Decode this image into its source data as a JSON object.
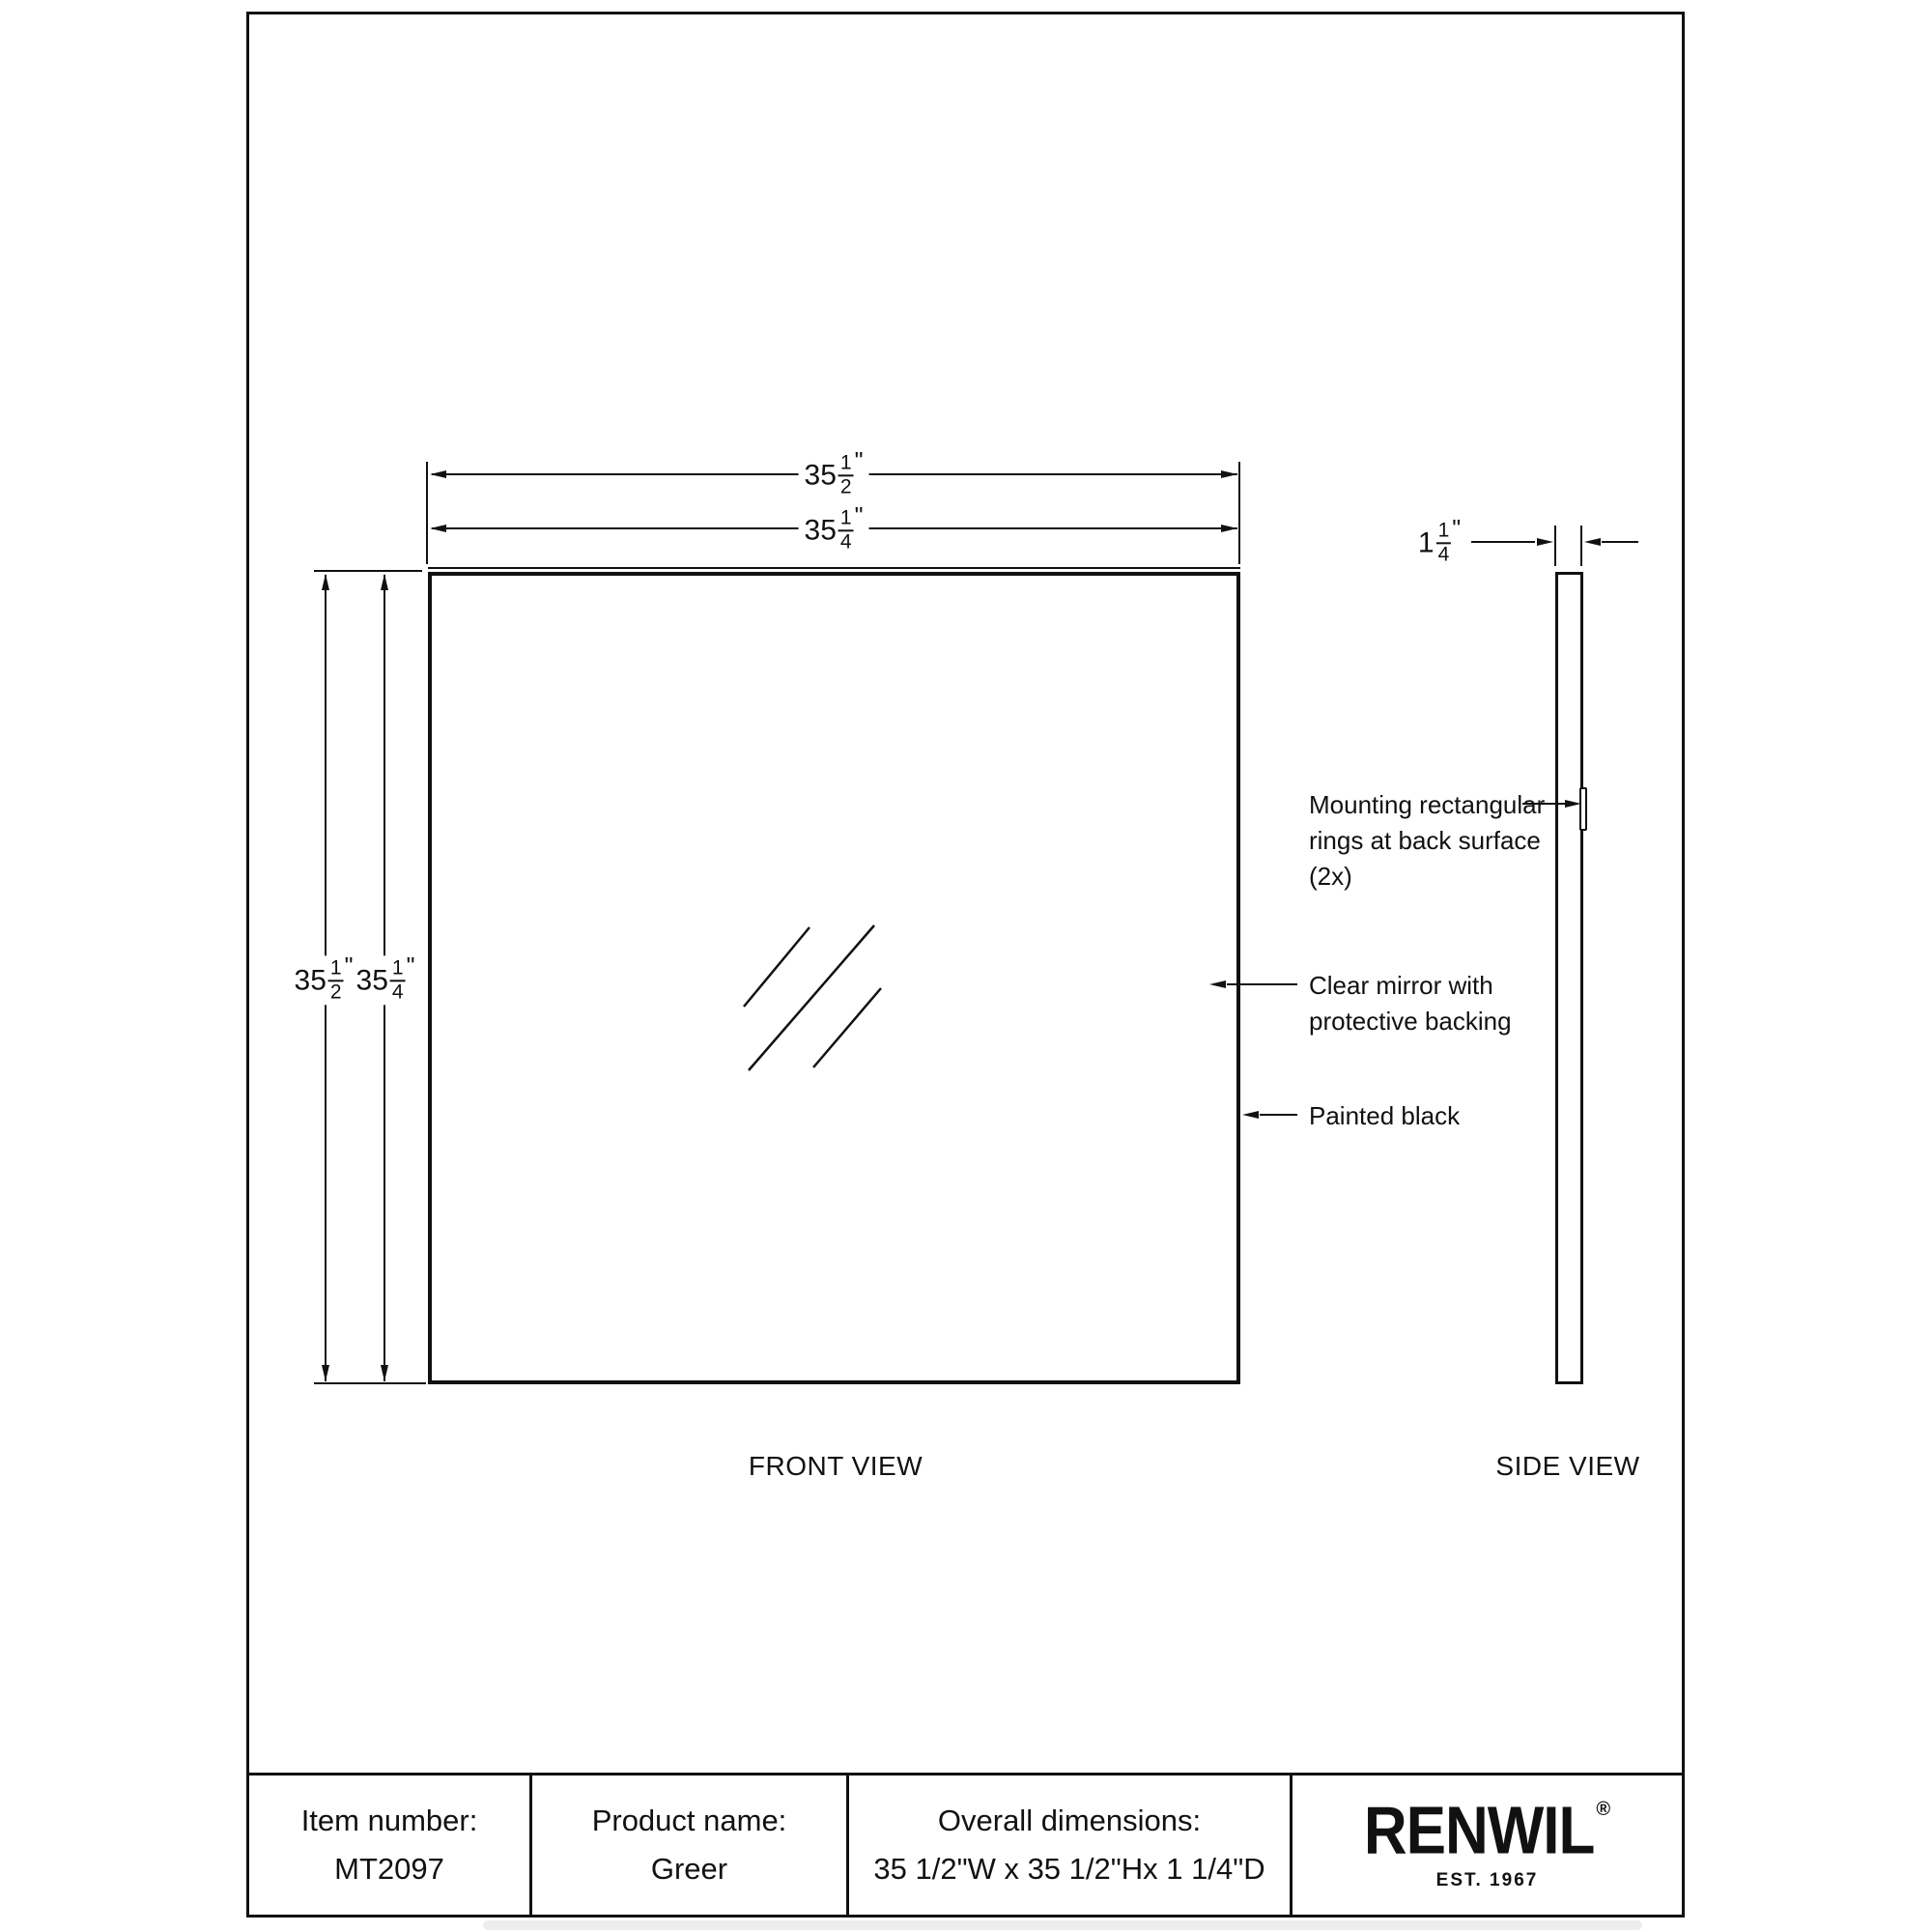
{
  "sheet": {
    "background": "#ffffff",
    "line_color": "#111111"
  },
  "dimensions": {
    "front_width_outer": {
      "whole": "35",
      "numerator": "1",
      "denominator": "2",
      "unit": "\""
    },
    "front_width_inner": {
      "whole": "35",
      "numerator": "1",
      "denominator": "4",
      "unit": "\""
    },
    "front_height_outer": {
      "whole": "35",
      "numerator": "1",
      "denominator": "2",
      "unit": "\""
    },
    "front_height_inner": {
      "whole": "35",
      "numerator": "1",
      "denominator": "4",
      "unit": "\""
    },
    "side_depth": {
      "whole": "1",
      "numerator": "1",
      "denominator": "4",
      "unit": "\""
    }
  },
  "annotations": {
    "mounting": {
      "lines": [
        "Mounting rectangular",
        "rings at back surface",
        "(2x)"
      ]
    },
    "mirror": {
      "lines": [
        "Clear mirror with",
        "protective backing"
      ]
    },
    "painted": {
      "lines": [
        "Painted black"
      ]
    }
  },
  "views": {
    "front_label": "FRONT VIEW",
    "side_label": "SIDE VIEW"
  },
  "footer": {
    "item_label": "Item number:",
    "item_value": "MT2097",
    "product_label": "Product name:",
    "product_value": "Greer",
    "overall_label": "Overall dimensions:",
    "overall_value": "35 1/2\"W x 35 1/2\"Hx 1 1/4\"D",
    "brand": "RENWIL",
    "registered": "®",
    "established": "EST. 1967"
  }
}
